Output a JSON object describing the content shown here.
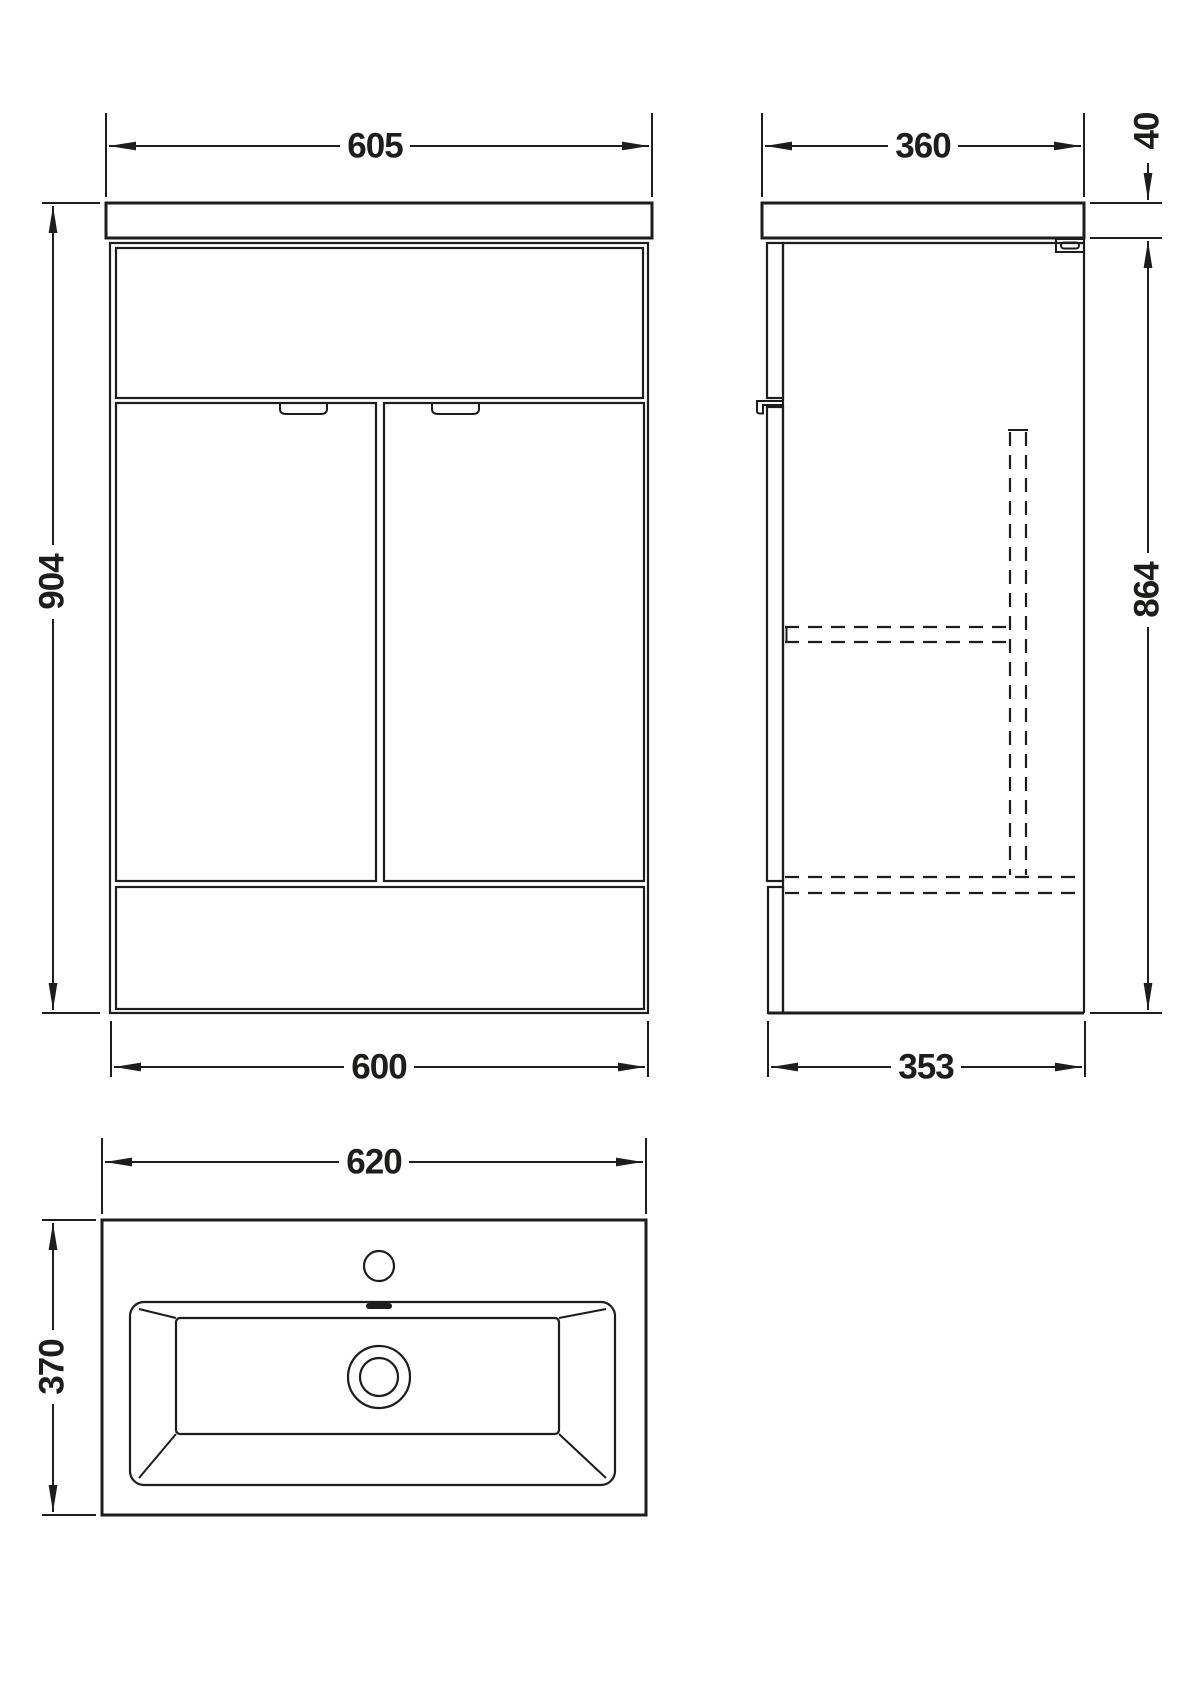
{
  "colors": {
    "line": "#1d1d1b",
    "background": "#ffffff"
  },
  "views": {
    "front": {
      "dims": {
        "counter_width": "605",
        "overall_height": "904",
        "cabinet_width": "600"
      }
    },
    "side": {
      "dims": {
        "counter_depth": "360",
        "counter_thickness": "40",
        "cabinet_height": "864",
        "cabinet_depth": "353"
      }
    },
    "basin": {
      "dims": {
        "basin_width": "620",
        "basin_depth": "370"
      }
    }
  }
}
